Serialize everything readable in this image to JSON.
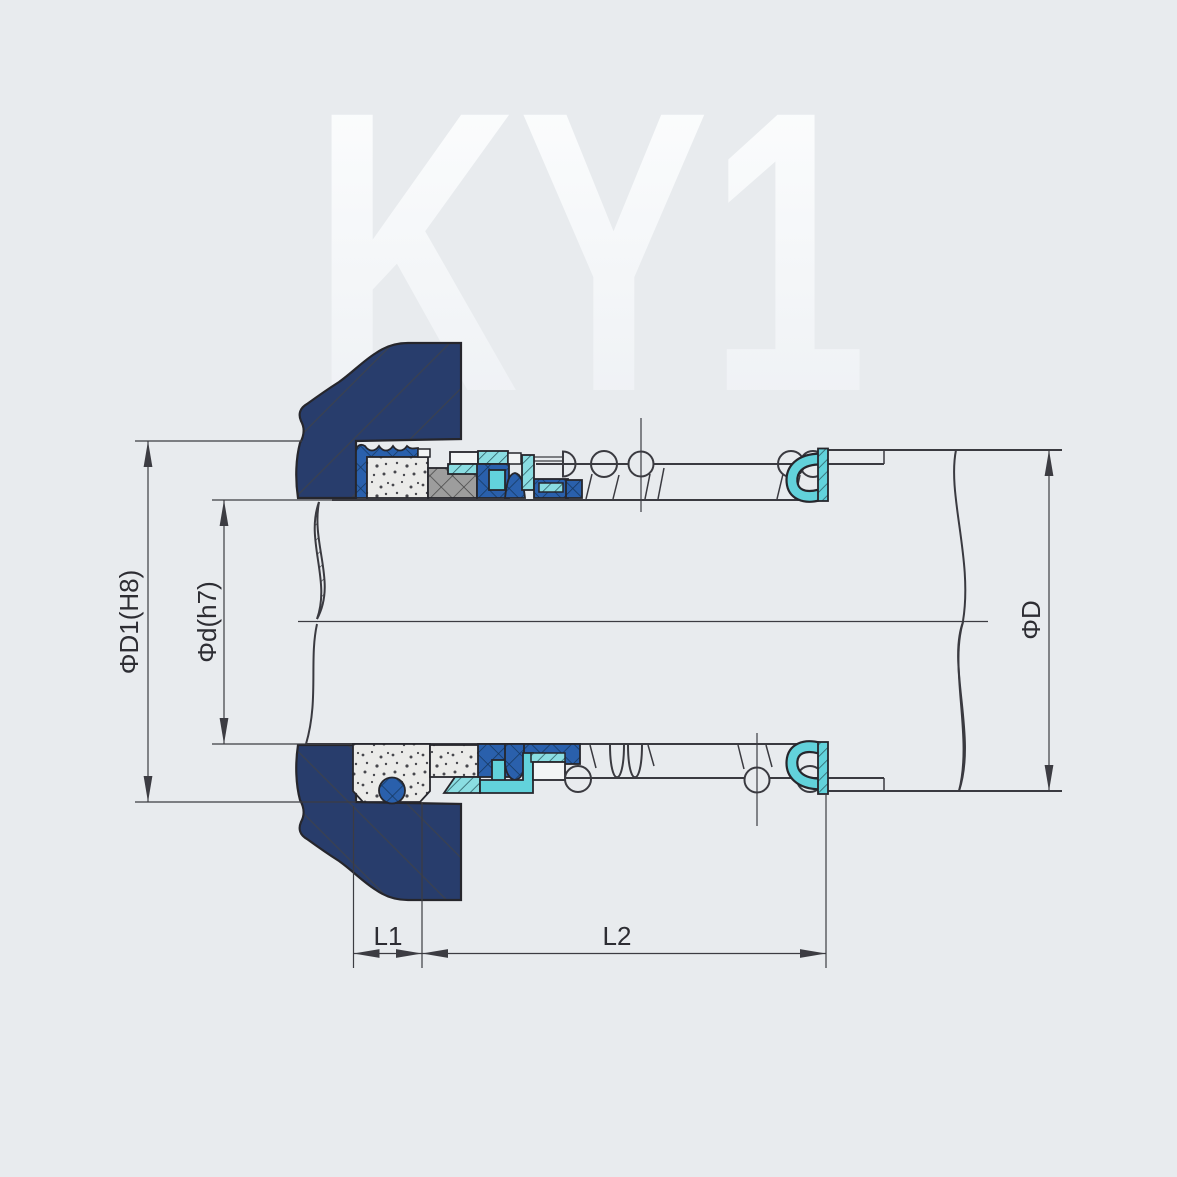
{
  "watermark": {
    "text": "KY1"
  },
  "labels": {
    "dim_d1": "ΦD1(H8)",
    "dim_d": "Φd(h7)",
    "dim_D": "ΦD",
    "dim_l1": "L1",
    "dim_l2": "L2"
  },
  "palette": {
    "bg": "#e8ebee",
    "wm_top": "#feffff",
    "wm_bottom": "#eceff3",
    "line": "#3a3a40",
    "dim": "#3c3c42",
    "text": "#2d2d33",
    "edge": "#26262c",
    "navy": "#283d6c",
    "navy_hatch": "#3a4150",
    "blue": "#2a60ac",
    "blue_hatch": "#16375f",
    "teal": "#8adde2",
    "teal_hatch": "#2e6067",
    "cyan_ring": "#62d2db",
    "gray": "#9d9d9d",
    "gray_hatch": "#474747",
    "paper": "#f2f4f5",
    "speckle_base": "#ebebe9",
    "speckle_dot": "#47474d"
  }
}
